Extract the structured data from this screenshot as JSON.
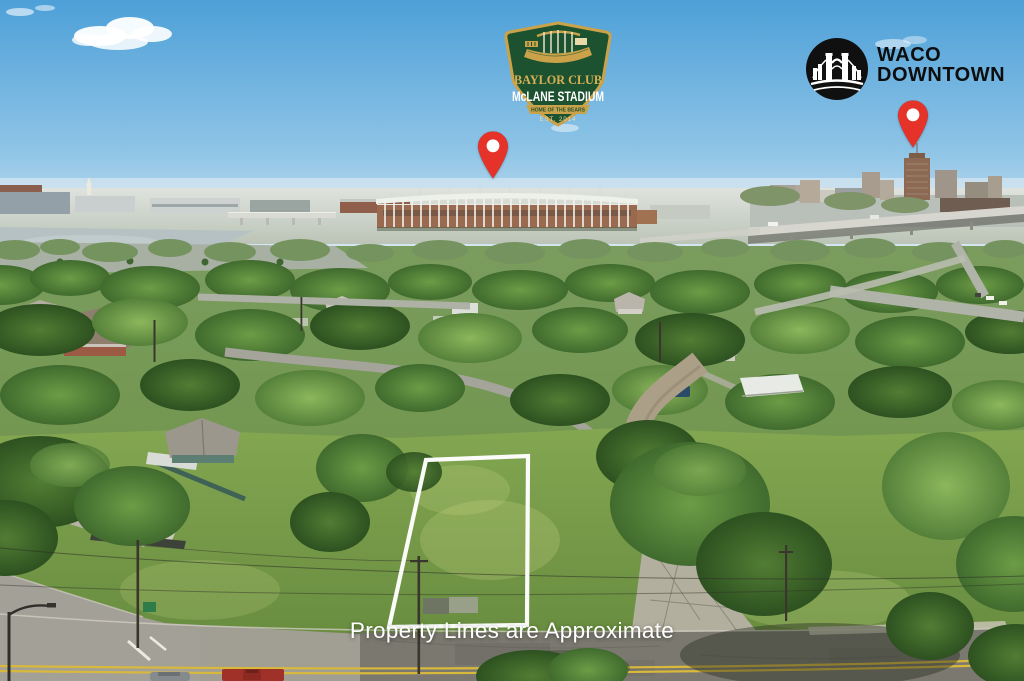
{
  "badges": {
    "baylor": {
      "club": "BAYLOR CLUB",
      "stadium": "McLANE STADIUM",
      "ribbon": "HOME OF THE BEARS",
      "est": "EST. 2014",
      "shield_green": "#1d5231",
      "gold": "#c9a24a"
    },
    "waco": {
      "line1": "WACO",
      "line2": "DOWNTOWN",
      "ink": "#0d0d0d",
      "icon": "waco-bridge-circle-icon"
    }
  },
  "pins": {
    "color": "#e6332a",
    "items": [
      {
        "id": "pin-mclane-stadium"
      },
      {
        "id": "pin-downtown-waco"
      }
    ]
  },
  "property": {
    "caption": "Property Lines are Approximate",
    "outline_color": "#ffffff"
  },
  "scene": {
    "colors": {
      "sky_top": "#4da0d8",
      "sky_horizon": "#d6e7f1",
      "grass": "#6f9444",
      "tree_dark": "#2d5120",
      "asphalt": "#7b796f",
      "concrete": "#a3a098",
      "dirt_road": "#ab9f88",
      "stadium_brick": "#9a6a50",
      "water": "#b5c1c3",
      "yellow_line": "#d9b93c"
    }
  }
}
